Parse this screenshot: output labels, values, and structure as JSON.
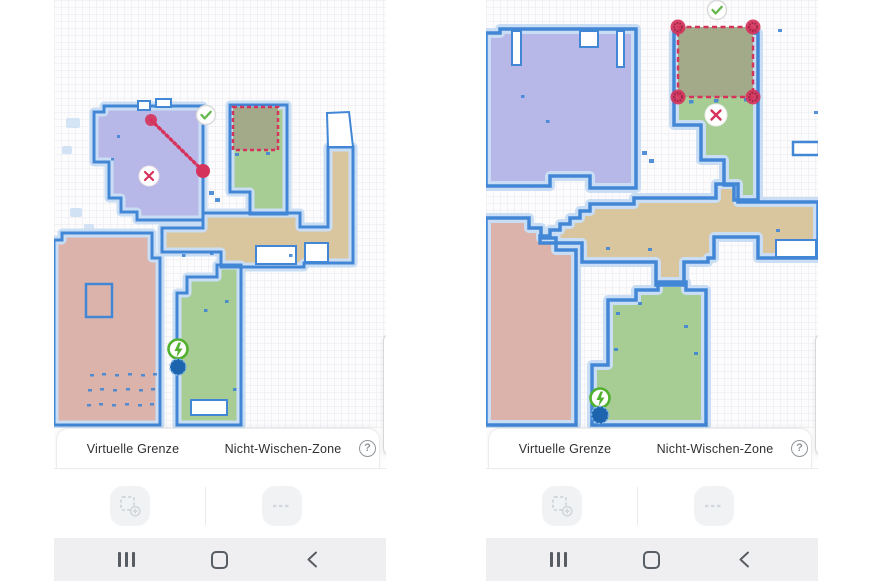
{
  "sheet": {
    "tabs": [
      {
        "label": "Virtuelle Grenze"
      },
      {
        "label": "Nicht-Wischen-Zone"
      }
    ],
    "help_label": "?"
  },
  "toolbar": {
    "buttons": [
      {
        "name": "add-no-mop-zone",
        "icon": "dashed-square-plus"
      },
      {
        "name": "add-virtual-wall",
        "icon": "dashed-line"
      }
    ]
  },
  "android_nav": {
    "buttons": [
      {
        "name": "recents",
        "icon": "three-bars"
      },
      {
        "name": "home",
        "icon": "rounded-square-outline"
      },
      {
        "name": "back",
        "icon": "chevron-left"
      }
    ]
  },
  "map_overlays": {
    "left_screenshot": {
      "virtual_wall": "diagonal-dotted-line-with-endpoint-handles",
      "no_mop_zone": "red-dashed-rectangle",
      "confirm_icon": "checkmark",
      "cancel_icon": "cross",
      "charger_icon": "lightning-bolt",
      "robot_icon": "filled-dot"
    },
    "right_screenshot": {
      "no_mop_zone": "red-dashed-rectangle-with-corner-handles",
      "confirm_icon": "checkmark",
      "cancel_icon": "cross",
      "charger_icon": "lightning-bolt",
      "robot_icon": "filled-dot"
    }
  },
  "colors": {
    "grid_line": "#e8e9ef",
    "wall_blue": "#4286d6",
    "halo_blue": "#c9def4",
    "room_purple": "#b7b8e8",
    "room_green": "#a7cd95",
    "room_tan": "#d9c69e",
    "room_pink": "#dcb3aa",
    "no_mop_fill": "#a2aa89",
    "boundary_red": "#d5335c",
    "handle_inner": "#9e2746",
    "confirm_green": "#65b84d",
    "charger_green": "#51b12f",
    "robot_blue": "#1c64ae",
    "robot_ring": "#7ab0e4",
    "sheet_text": "#2f3033",
    "help_gray": "#909499",
    "button_bg": "#f0f2f4",
    "button_icon": "#d3d8dd",
    "navbar_bg": "#efeff1",
    "navbar_icon": "#585d64",
    "divider": "#ebebeb"
  }
}
